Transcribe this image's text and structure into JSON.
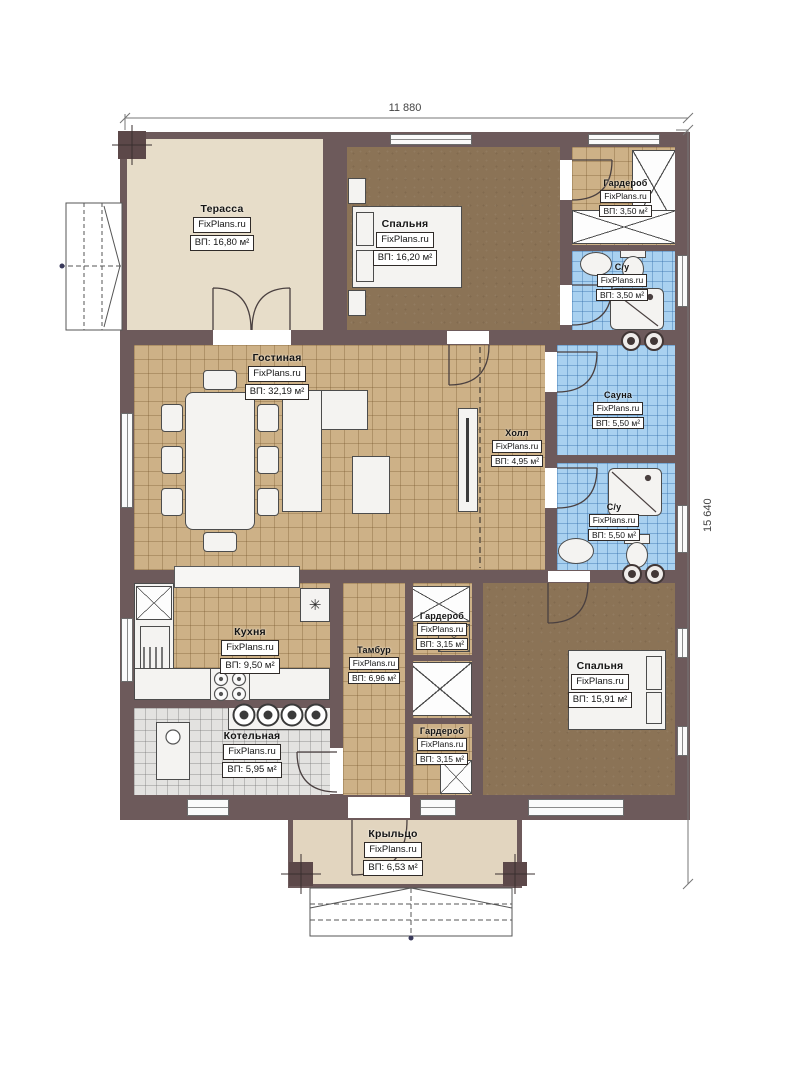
{
  "brand": "FixPlans.ru",
  "dimensions": {
    "width": "11 880",
    "height": "15 640"
  },
  "rooms": {
    "terrace": {
      "name": "Терасса",
      "area": "ВП: 16,80 м²"
    },
    "bedroom_top": {
      "name": "Спальня",
      "area": "ВП: 16,20 м²"
    },
    "wardrobe_top": {
      "name": "Гардероб",
      "area": "ВП: 3,50 м²"
    },
    "bath_top": {
      "name": "С/у",
      "area": "ВП: 3,50 м²"
    },
    "living": {
      "name": "Гостиная",
      "area": "ВП: 32,19 м²"
    },
    "hall": {
      "name": "Холл",
      "area": "ВП: 4,95 м²"
    },
    "sauna": {
      "name": "Сауна",
      "area": "ВП: 5,50 м²"
    },
    "bath_mid": {
      "name": "С/у",
      "area": "ВП: 5,50 м²"
    },
    "kitchen": {
      "name": "Кухня",
      "area": "ВП: 9,50 м²"
    },
    "vestibule": {
      "name": "Тамбур",
      "area": "ВП: 6,96 м²"
    },
    "wardrobe_mid": {
      "name": "Гардероб",
      "area": "ВП: 3,15 м²"
    },
    "bedroom_bot": {
      "name": "Спальня",
      "area": "ВП: 15,91 м²"
    },
    "boiler": {
      "name": "Котельная",
      "area": "ВП: 5,95 м²"
    },
    "wardrobe_bot": {
      "name": "Гардероб",
      "area": "ВП: 3,15 м²"
    },
    "porch": {
      "name": "Крыльцо",
      "area": "ВП: 6,53 м²"
    }
  },
  "symbols": {
    "fridge": "✳"
  },
  "colors": {
    "wall": "#6d5a5b",
    "column": "#5c4849",
    "floor_beige": "#e7ddc9",
    "floor_porch": "#e2d5bf",
    "floor_brown": "#8b7356",
    "floor_tan": "#cdb187",
    "floor_blue": "#a9d1f0",
    "floor_gray": "#e3e2e0",
    "line": "#4a4040"
  }
}
